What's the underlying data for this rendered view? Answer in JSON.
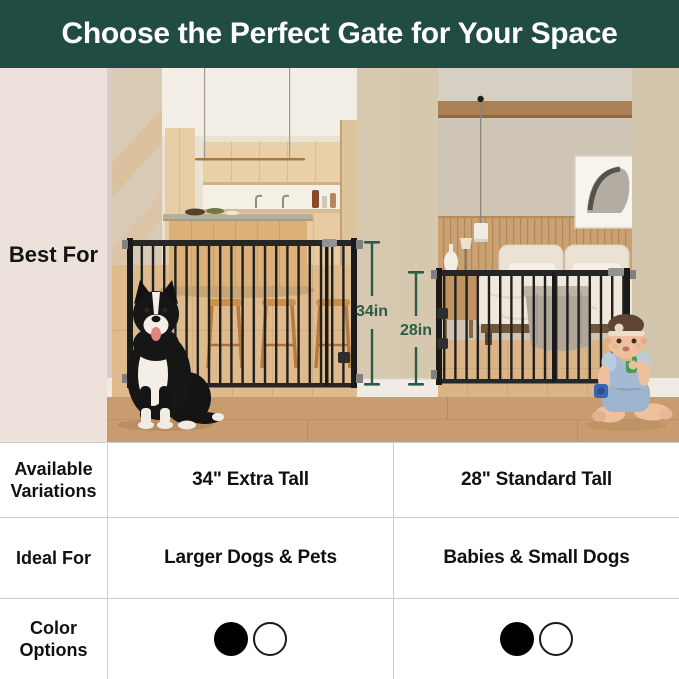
{
  "header": {
    "title": "Choose the Perfect Gate for Your Space"
  },
  "hero": {
    "row_label": "Best For",
    "left_gate": {
      "height_label": "34in",
      "scene_description": "Extra tall black metal gate across a kitchen doorway with a border collie sitting in front"
    },
    "right_gate": {
      "height_label": "28in",
      "scene_description": "Standard tall black metal gate across a bedroom doorway with a baby sitting in front"
    }
  },
  "table": {
    "rows": [
      {
        "label": "Available Variations",
        "left": "34\" Extra Tall",
        "right": "28\" Standard Tall"
      },
      {
        "label": "Ideal For",
        "left": "Larger Dogs & Pets",
        "right": "Babies & Small Dogs"
      },
      {
        "label": "Color Options",
        "left_swatches": [
          {
            "name": "black",
            "hex": "#000000"
          },
          {
            "name": "white",
            "hex": "#ffffff"
          }
        ],
        "right_swatches": [
          {
            "name": "black",
            "hex": "#000000"
          },
          {
            "name": "white",
            "hex": "#ffffff"
          }
        ]
      }
    ]
  },
  "colors": {
    "header_bg": "#214c44",
    "label_panel_bg": "#ece2db",
    "annotation_green": "#2b5c4a",
    "grid_line": "#cccccc"
  }
}
